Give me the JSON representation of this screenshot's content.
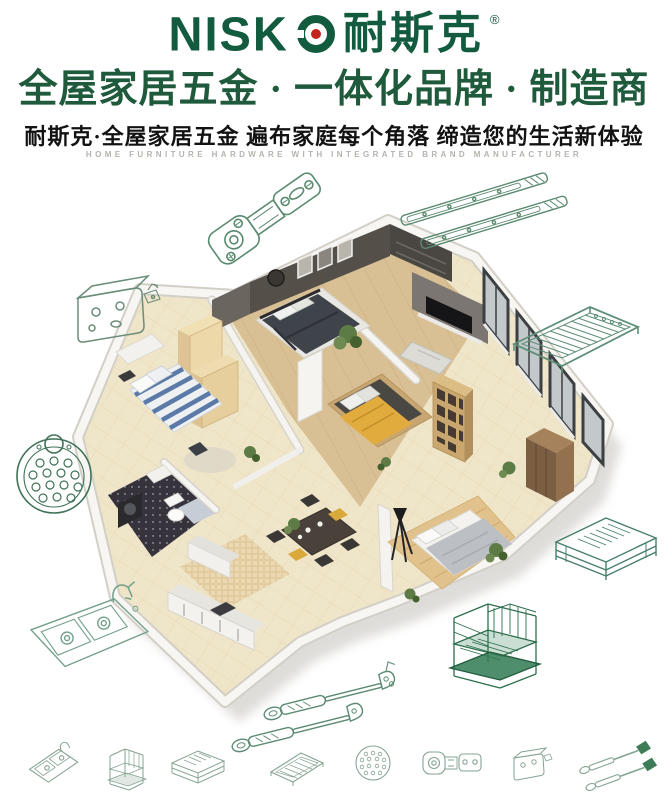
{
  "page": {
    "background": "#ffffff"
  },
  "brand": {
    "latin": "NISKO",
    "latin_display": "NISK",
    "cjk": "耐斯克",
    "registered": "®",
    "logo_green": "#125b3e",
    "logo_red_dot": "#c2231d"
  },
  "header": {
    "headline": "全屋家居五金 · 一体化品牌 · 制造商",
    "subheadline": "耐斯克·全屋家居五金  遍布家庭每个角落  缔造您的生活新体验",
    "tagline_en": "HOME FURNITURE HARDWARE WITH INTEGRATED BRAND MANUFACTURER",
    "colors": {
      "headline_green": "#1e5a3b",
      "subheadline_black": "#121212",
      "tagline_gray": "#b5b3ae"
    }
  },
  "hero": {
    "subject": "3d-isometric-apartment-cutaway",
    "rooms_depicted": [
      "master-bedroom",
      "second-bedroom",
      "living-area",
      "kitchen",
      "bathroom",
      "dining-area",
      "balcony",
      "small-bedroom"
    ],
    "palette": {
      "floor_tile": "#efe5c9",
      "wood_floor": "#d8bf94",
      "accent_wall": "#544f49",
      "bed_dark": "#3f434a",
      "accent_yellow": "#e2ab3d",
      "stripe_blue": "#5b7aa8",
      "plant_green": "#5d7b45",
      "wall_white": "#f7f6f3"
    }
  },
  "products": {
    "line_color": "#5a8a6f",
    "dark_line_color": "#2c6e4b",
    "footer_line_color": "#86a492",
    "drawings": [
      {
        "id": "concealed-hinge"
      },
      {
        "id": "ball-bearing-drawer-slides"
      },
      {
        "id": "mounting-bracket"
      },
      {
        "id": "wire-shelf-tray"
      },
      {
        "id": "perforated-round-plate"
      },
      {
        "id": "pullout-wire-basket"
      },
      {
        "id": "double-bowl-sink-with-faucet"
      },
      {
        "id": "gas-lift-struts"
      },
      {
        "id": "kitchen-organizer-rack"
      }
    ],
    "footer_icons": [
      {
        "id": "double-sink"
      },
      {
        "id": "cabinet-rack"
      },
      {
        "id": "drawer-basket"
      },
      {
        "id": "wire-shelf"
      },
      {
        "id": "perforated-ball"
      },
      {
        "id": "concealed-hinge"
      },
      {
        "id": "hinge-bracket"
      },
      {
        "id": "gas-struts"
      }
    ]
  }
}
